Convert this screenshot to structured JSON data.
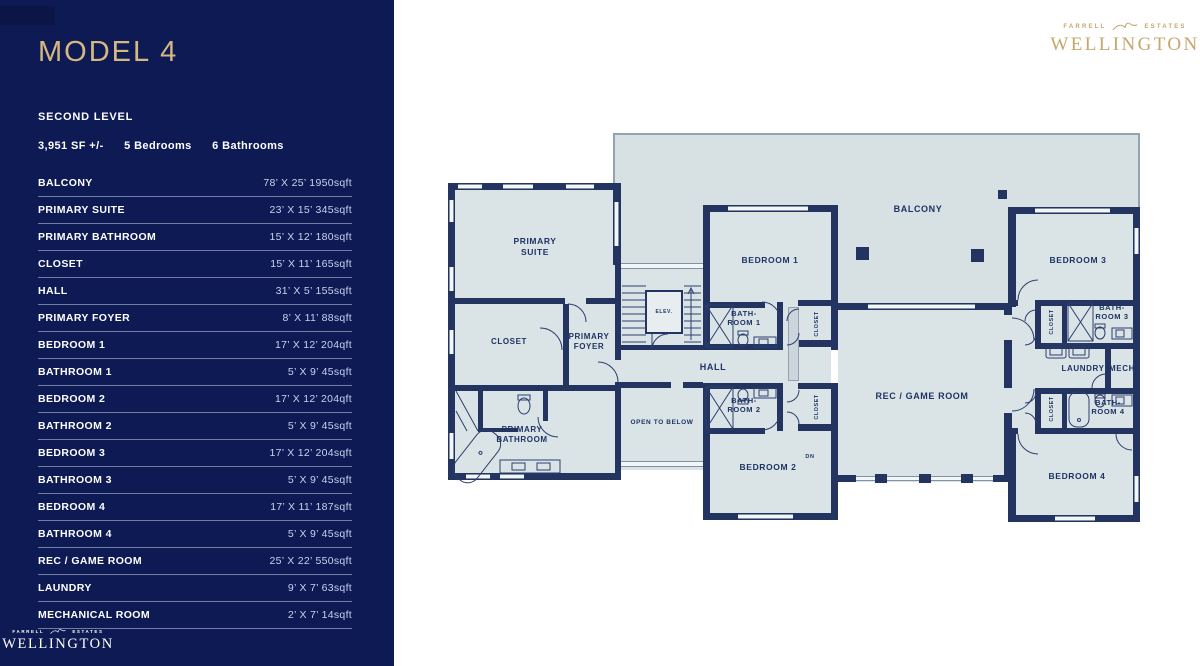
{
  "colors": {
    "sidebar_navy": "#0d1a54",
    "gold": "#d5b87f",
    "logo_gold": "#c5a76c",
    "wall_navy": "#22345f",
    "room_fill": "#dae4e6",
    "balcony_fill": "#d7e1e3",
    "plan_label": "#1e3364",
    "dims_text": "#c9d2ec"
  },
  "header": {
    "model": "MODEL 4",
    "level": "SECOND LEVEL",
    "stats": {
      "sf": "3,951 SF +/-",
      "bedrooms": "5 Bedrooms",
      "bathrooms": "6 Bathrooms"
    }
  },
  "brand": {
    "farrell": "FARRELL",
    "estates": "ESTATES",
    "wellington": "WELLINGTON"
  },
  "table": {
    "rows": [
      {
        "name": "BALCONY",
        "dims": "78’ X 25’ 1950sqft"
      },
      {
        "name": "PRIMARY SUITE",
        "dims": "23’ X 15’ 345sqft"
      },
      {
        "name": "PRIMARY BATHROOM",
        "dims": "15’ X 12’ 180sqft"
      },
      {
        "name": "CLOSET",
        "dims": "15’ X 11’ 165sqft"
      },
      {
        "name": "HALL",
        "dims": "31’ X 5’ 155sqft"
      },
      {
        "name": "PRIMARY FOYER",
        "dims": "8’ X 11’ 88sqft"
      },
      {
        "name": "BEDROOM 1",
        "dims": "17’ X 12’ 204qft"
      },
      {
        "name": "BATHROOM 1",
        "dims": "5’ X 9’ 45sqft"
      },
      {
        "name": "BEDROOM 2",
        "dims": "17’ X 12’ 204qft"
      },
      {
        "name": "BATHROOM 2",
        "dims": "5’ X 9’ 45sqft"
      },
      {
        "name": "BEDROOM 3",
        "dims": "17’ X 12’ 204sqft"
      },
      {
        "name": "BATHROOM 3",
        "dims": "5’ X 9’ 45sqft"
      },
      {
        "name": "BEDROOM 4",
        "dims": "17’ X 11’ 187sqft"
      },
      {
        "name": "BATHROOM 4",
        "dims": "5’ X 9’ 45sqft"
      },
      {
        "name": "REC / GAME ROOM",
        "dims": "25’ X 22’ 550sqft"
      },
      {
        "name": "LAUNDRY",
        "dims": "9’ X 7’ 63sqft"
      },
      {
        "name": "MECHANICAL ROOM",
        "dims": "2’ X 7’ 14sqft"
      }
    ]
  },
  "plan": {
    "balcony": "BALCONY",
    "primary_suite": {
      "l1": "PRIMARY",
      "l2": "SUITE"
    },
    "closet": "CLOSET",
    "primary_foyer": {
      "l1": "PRIMARY",
      "l2": "FOYER"
    },
    "primary_bathroom": {
      "l1": "PRIMARY",
      "l2": "BATHROOM"
    },
    "hall": "HALL",
    "open_to_below": "OPEN TO BELOW",
    "elevator": "ELEV.",
    "dn": "DN",
    "bedroom1": "BEDROOM 1",
    "bathroom1": {
      "l1": "BATH-",
      "l2": "ROOM 1"
    },
    "bedroom2": "BEDROOM 2",
    "bathroom2": {
      "l1": "BATH-",
      "l2": "ROOM 2"
    },
    "rec_game_room": "REC / GAME ROOM",
    "bedroom3": "BEDROOM 3",
    "bathroom3": {
      "l1": "BATH-",
      "l2": "ROOM 3"
    },
    "laundry": "LAUNDRY",
    "mech": "MECH",
    "bathroom4": {
      "l1": "BATH-",
      "l2": "ROOM 4"
    },
    "bedroom4": "BEDROOM 4"
  }
}
